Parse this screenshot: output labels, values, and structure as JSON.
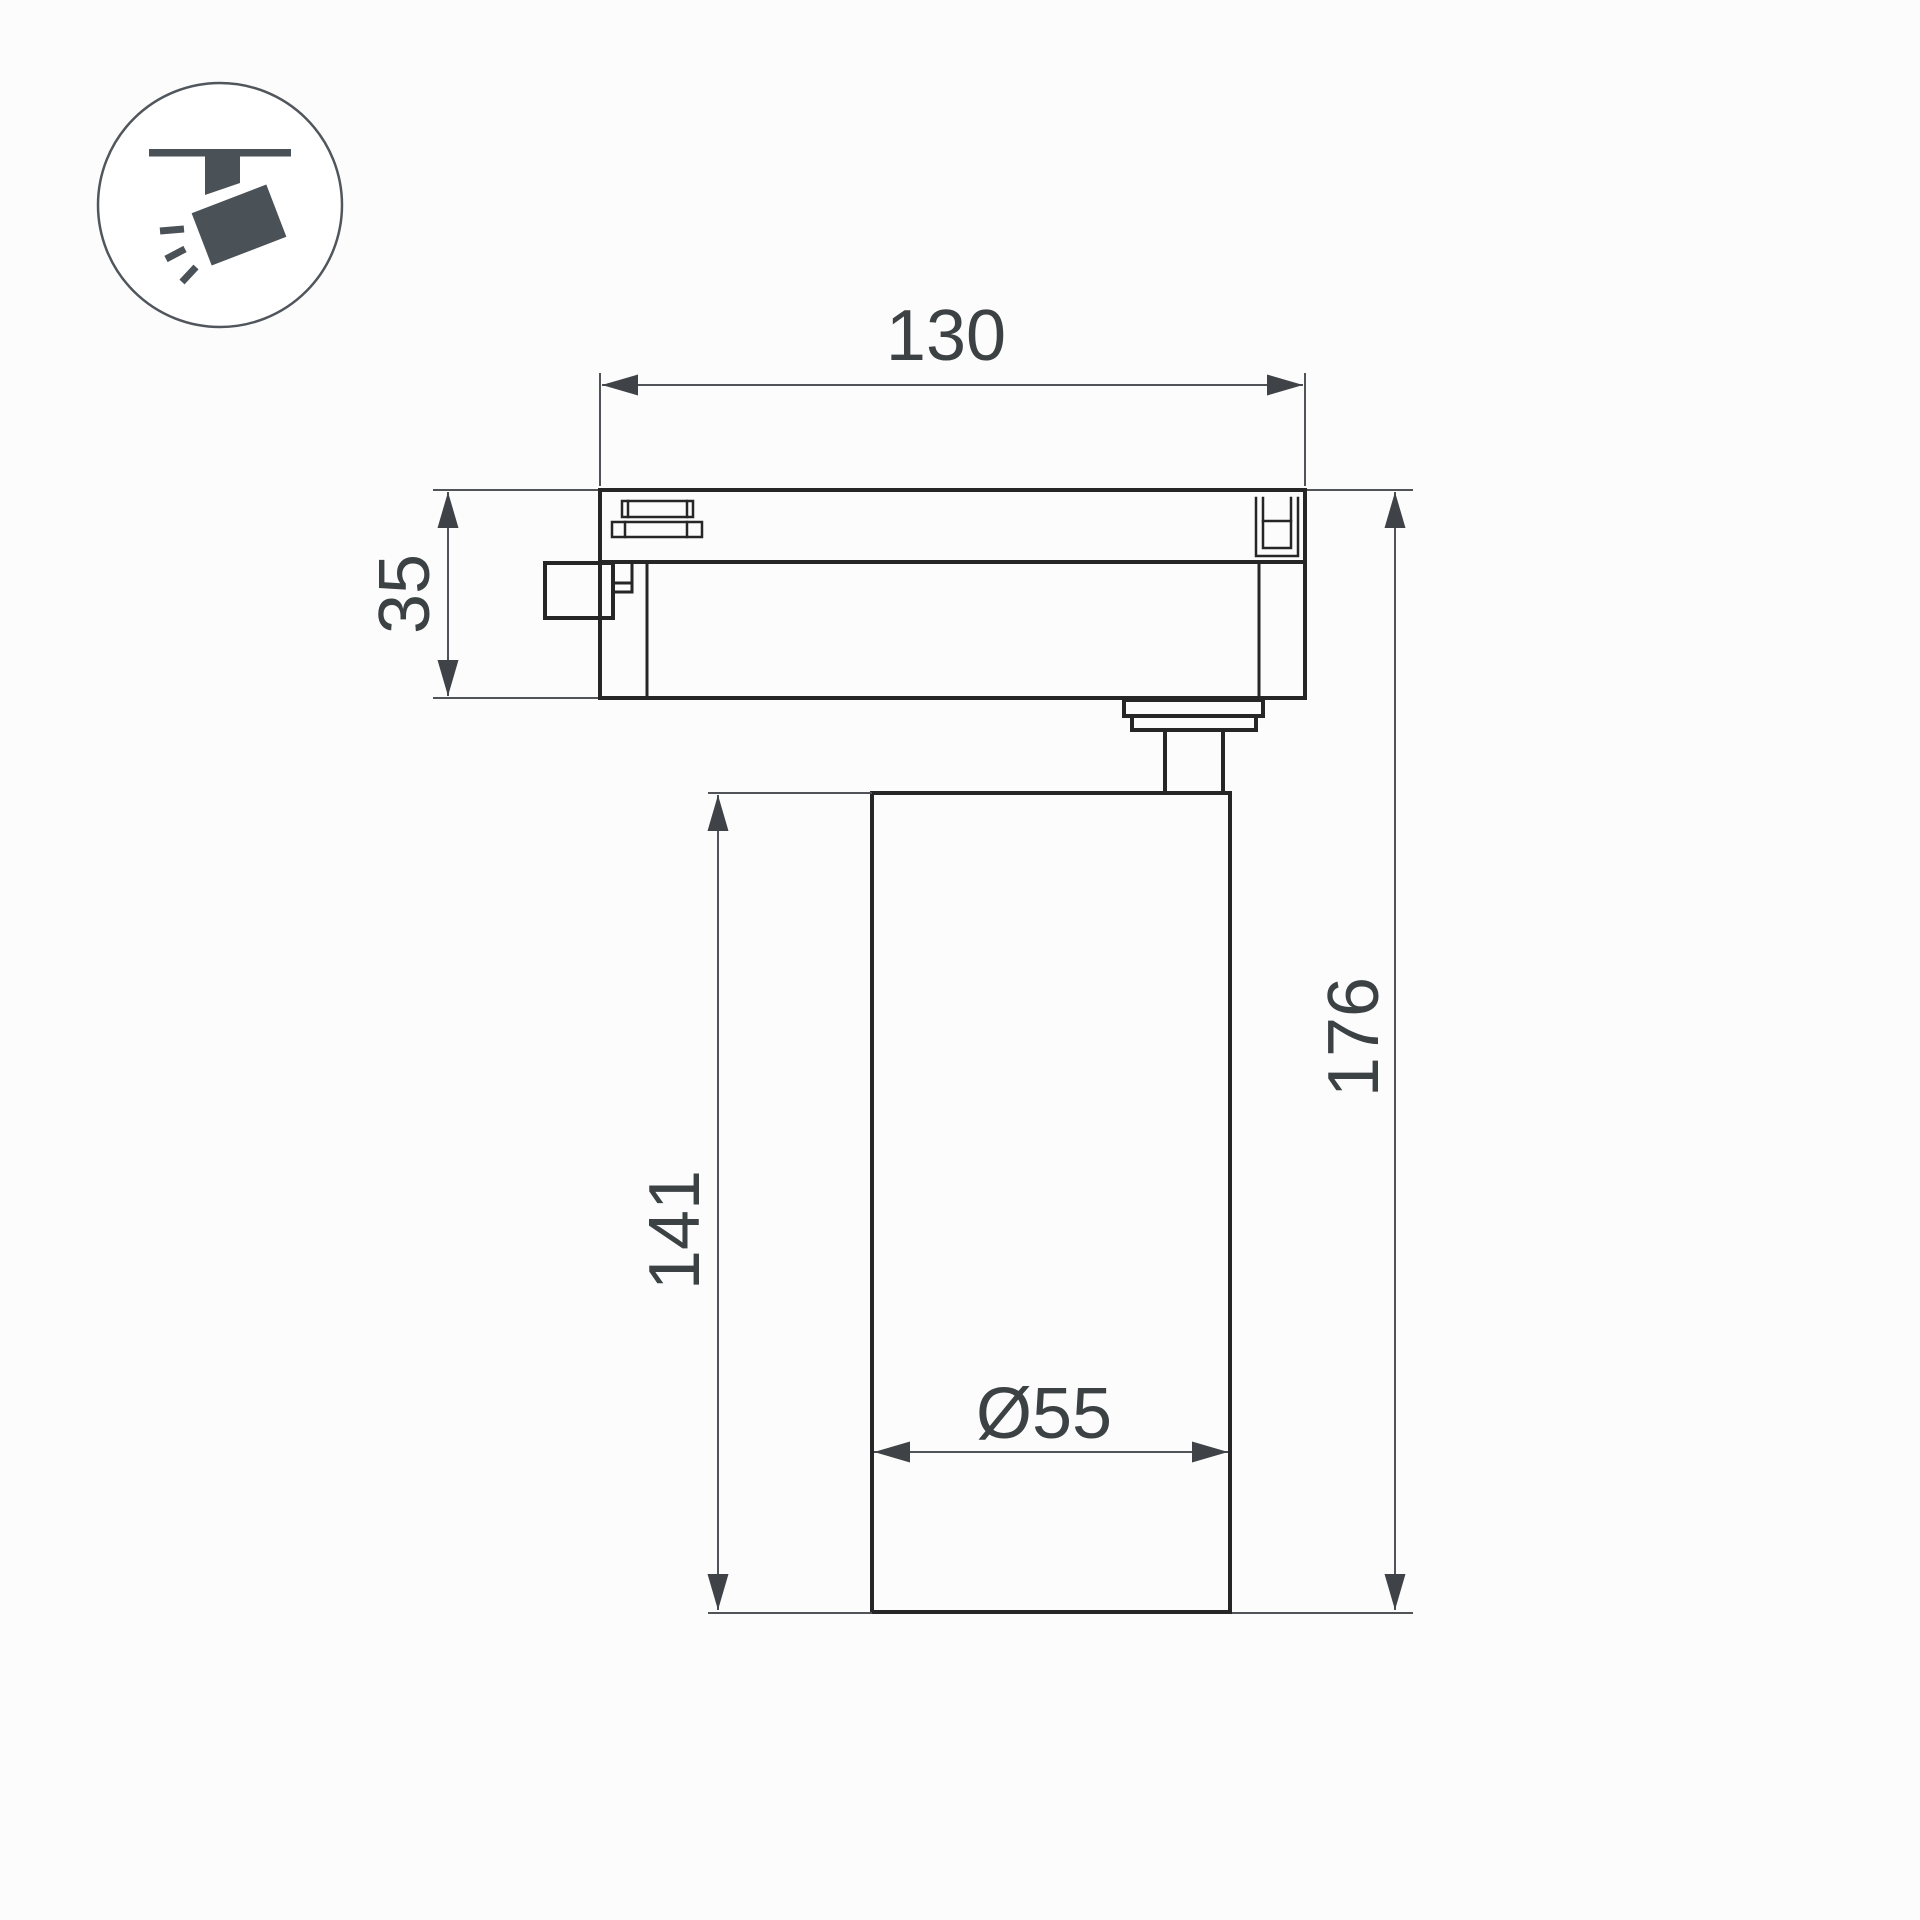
{
  "icon": {
    "name": "track-spotlight-pictogram",
    "color": "#4a5157"
  },
  "drawing": {
    "subject": "track-light-dimension-drawing",
    "line_color": "#262626",
    "dimension_color": "#505458",
    "dimensions": [
      {
        "id": "track-adapter-length",
        "label": "130",
        "orientation": "horizontal"
      },
      {
        "id": "track-adapter-height",
        "label": "35",
        "orientation": "vertical"
      },
      {
        "id": "lamp-body-height",
        "label": "141",
        "orientation": "vertical"
      },
      {
        "id": "total-height",
        "label": "176",
        "orientation": "vertical"
      },
      {
        "id": "lamp-body-diameter",
        "label": "Ø55",
        "orientation": "horizontal"
      }
    ]
  }
}
